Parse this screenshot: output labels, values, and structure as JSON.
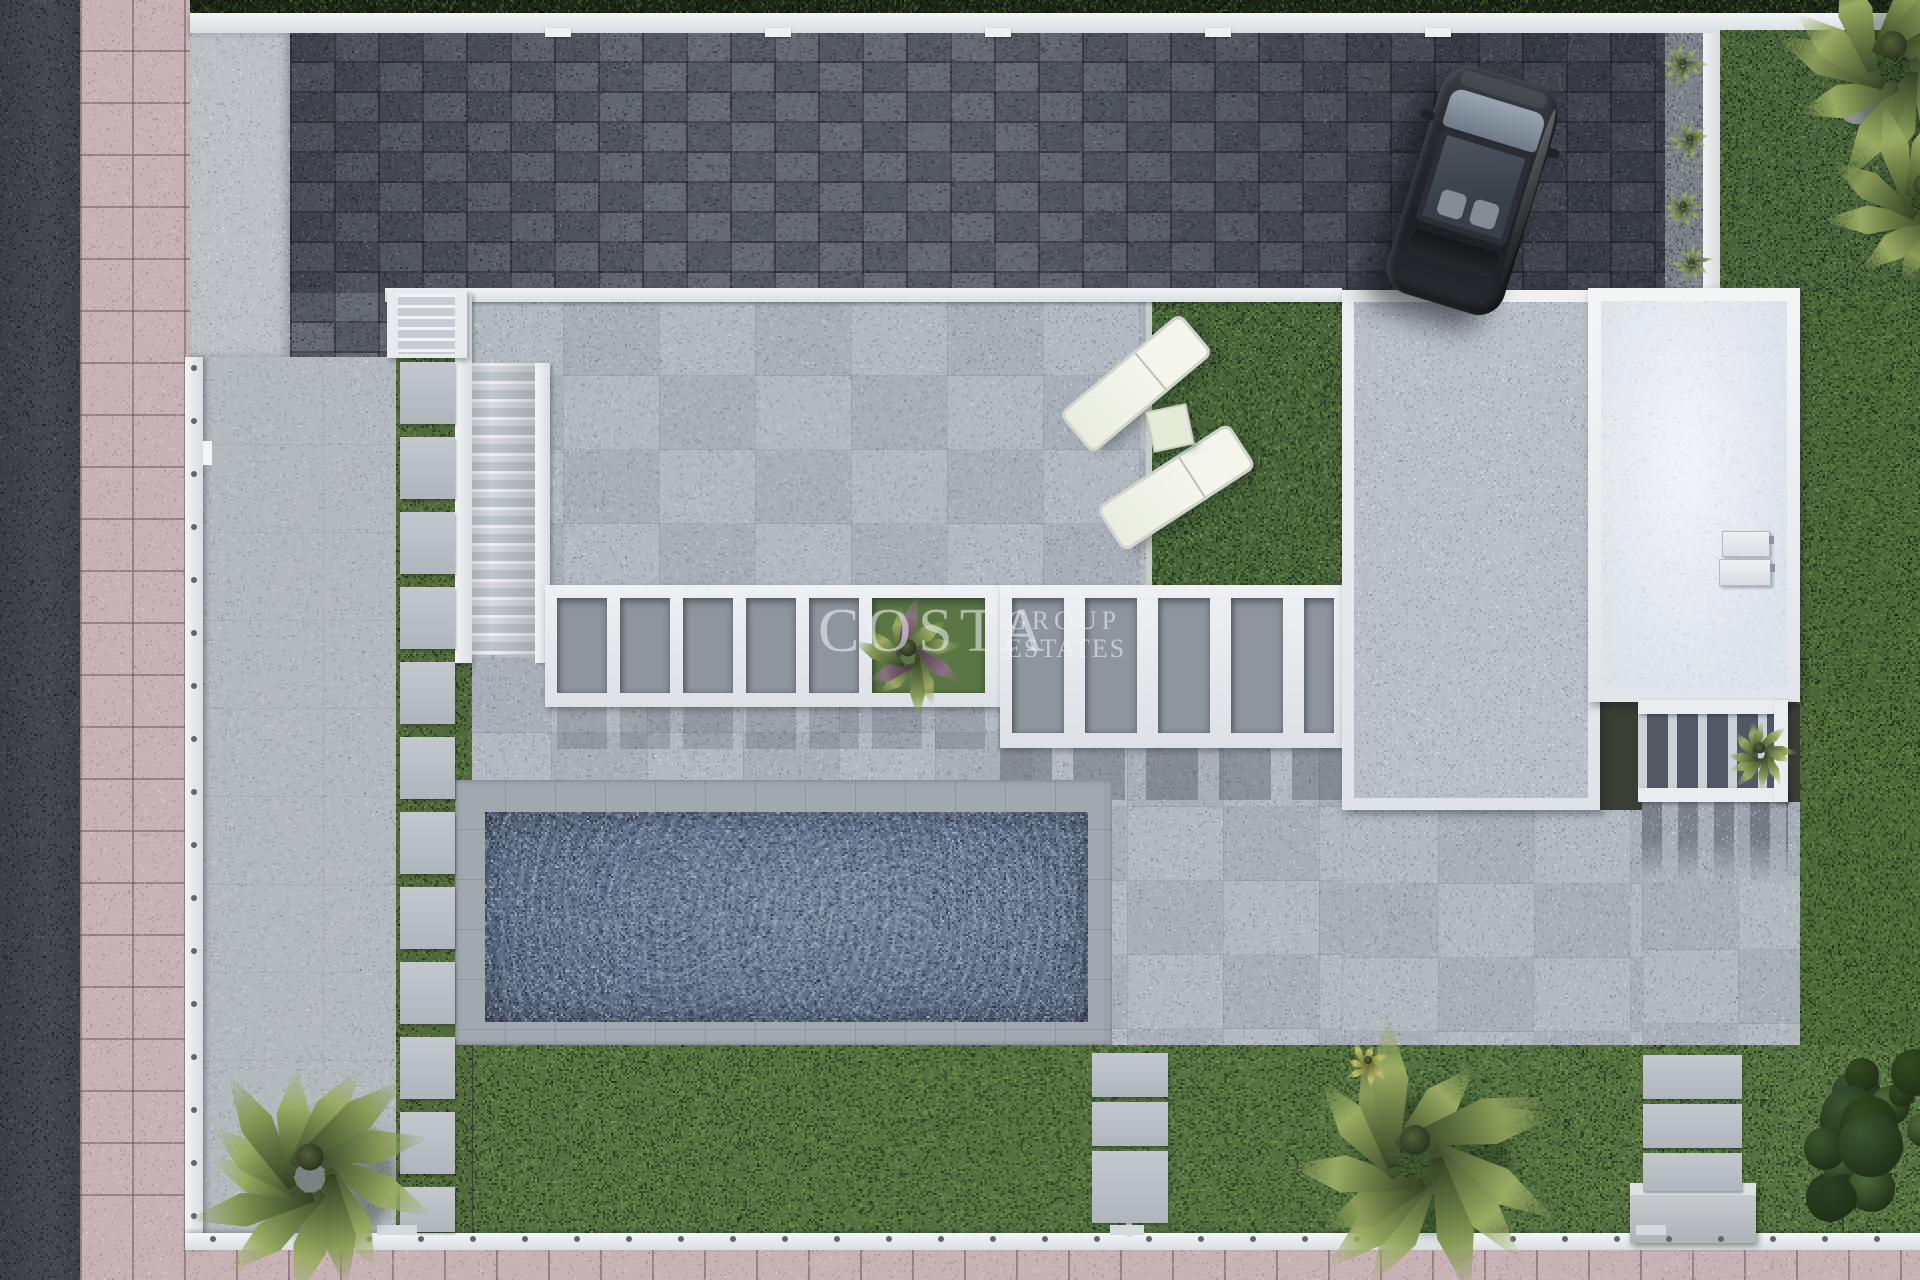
{
  "scene": {
    "kind": "aerial-3d-render",
    "description": "Top-down 3D architectural render of a modern villa plot with swimming pool, lawns, paver driveway, parked car, pergolas and palm trees",
    "watermark": {
      "word1": "COSTA",
      "word2": "GROUP",
      "word3": "ESTATES"
    }
  },
  "palette": {
    "asphalt": "#42464b",
    "sidewalk": "#c7b2b5",
    "paver": "#5b6068",
    "terrace": "#aeb5bd",
    "patio": "#b4b9be",
    "concrete": "#bcc0c5",
    "white": "#eceff2",
    "grass": "#4f6b3c",
    "grassDark": "#47613a",
    "water": "#5d7088",
    "coping": "#a2a8b0",
    "roofGray": "#b9bfc7",
    "roofWhite": "#e7ebf1",
    "hedge": "#1c2718",
    "carBody": "#24272c",
    "gravel": "#7b8187"
  },
  "pergola": {
    "west": {
      "openTop": 598,
      "openH": 95,
      "openings": [
        {
          "x": 557,
          "w": 50
        },
        {
          "x": 620,
          "w": 50
        },
        {
          "x": 683,
          "w": 50
        },
        {
          "x": 746,
          "w": 50
        },
        {
          "x": 809,
          "w": 50
        },
        {
          "x": 872,
          "w": 113,
          "plant": true
        }
      ]
    },
    "east": {
      "openTop": 598,
      "openH": 135,
      "openings": [
        {
          "x": 1012,
          "w": 52
        },
        {
          "x": 1085,
          "w": 52
        },
        {
          "x": 1158,
          "w": 52
        },
        {
          "x": 1231,
          "w": 52
        },
        {
          "x": 1304,
          "w": 30
        }
      ]
    }
  },
  "path": {
    "x": 400,
    "w": 55,
    "firstY": 362,
    "pitch": 75,
    "lastY": 1232
  },
  "lawnSlabs": [
    {
      "x": 1092,
      "w": 76,
      "rows": [
        [
          1053,
          44
        ],
        [
          1102,
          44
        ],
        [
          1151,
          72
        ]
      ]
    },
    {
      "x": 1643,
      "w": 99,
      "rows": [
        [
          1055,
          44
        ],
        [
          1104,
          44
        ],
        [
          1153,
          38
        ]
      ]
    }
  ],
  "fence": {
    "south": {
      "y": 1236,
      "x1": 210,
      "x2": 1900,
      "step": 52
    },
    "west": {
      "x": 191,
      "y1": 365,
      "y2": 1225,
      "step": 53
    }
  },
  "wallLights": {
    "y": 28,
    "xs": [
      545,
      765,
      985,
      1205,
      1425
    ]
  },
  "wallTabs": [
    [
      377,
      1225,
      40
    ],
    [
      1110,
      1225,
      34
    ],
    [
      1636,
      1225,
      30
    ]
  ],
  "vegetation": [
    {
      "kind": "palm",
      "x": 310,
      "y": 1157,
      "r": 135,
      "fronds": 13,
      "seed": 3
    },
    {
      "kind": "palm",
      "x": 1415,
      "y": 1140,
      "r": 150,
      "fronds": 13,
      "seed": 7
    },
    {
      "kind": "palm",
      "x": 1893,
      "y": 45,
      "r": 140,
      "fronds": 11,
      "seed": 5
    },
    {
      "kind": "palm",
      "x": 1925,
      "y": 185,
      "r": 115,
      "fronds": 10,
      "seed": 11
    },
    {
      "kind": "bush",
      "x": 1868,
      "y": 1135,
      "r": 115,
      "seed": 13
    },
    {
      "kind": "plant",
      "x": 908,
      "y": 648,
      "r": 62,
      "seed": 17,
      "purple": true
    },
    {
      "kind": "plant",
      "x": 1760,
      "y": 748,
      "r": 40,
      "seed": 19
    },
    {
      "kind": "agave",
      "x": 1683,
      "y": 62,
      "r": 26,
      "seed": 23
    },
    {
      "kind": "agave",
      "x": 1690,
      "y": 138,
      "r": 24,
      "seed": 29
    },
    {
      "kind": "agave",
      "x": 1683,
      "y": 205,
      "r": 25,
      "seed": 31
    },
    {
      "kind": "agave",
      "x": 1692,
      "y": 262,
      "r": 23,
      "seed": 37
    },
    {
      "kind": "tuft",
      "x": 1368,
      "y": 1060,
      "r": 28,
      "seed": 41
    }
  ]
}
